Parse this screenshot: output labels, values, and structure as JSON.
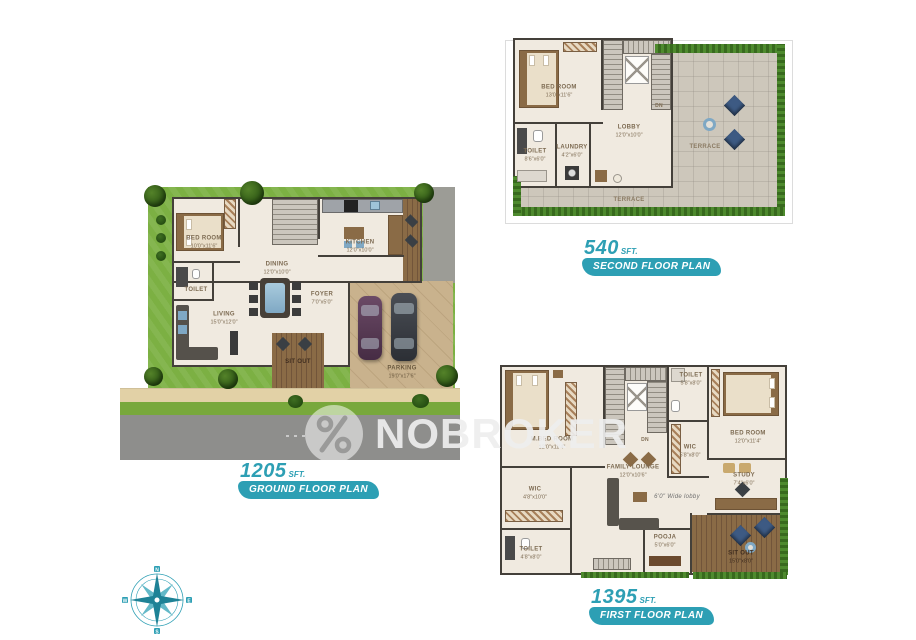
{
  "brand": {
    "watermark": "NOBROKER"
  },
  "ground_floor": {
    "area": "1205",
    "unit": "SFT.",
    "badge": "GROUND FLOOR PLAN",
    "rooms": {
      "bedroom": {
        "name": "BED ROOM",
        "dims": "10'0\"x11'6\""
      },
      "toilet": {
        "name": "TOILET",
        "dims": "7'0\"x5'0\""
      },
      "dining": {
        "name": "DINING",
        "dims": "12'0\"x10'0\""
      },
      "kitchen": {
        "name": "KITCHEN",
        "dims": "12'0\"x10'0\""
      },
      "living": {
        "name": "LIVING",
        "dims": "15'0\"x12'0\""
      },
      "foyer": {
        "name": "FOYER",
        "dims": "7'0\"x5'0\""
      },
      "sitout": {
        "name": "SIT OUT",
        "dims": "12'0\"x6'0\""
      },
      "parking": {
        "name": "PARKING",
        "dims": "19'0\"x17'6\""
      }
    }
  },
  "second_floor": {
    "area": "540",
    "unit": "SFT.",
    "badge": "SECOND FLOOR PLAN",
    "rooms": {
      "bedroom": {
        "name": "BED ROOM",
        "dims": "13'0\"x11'6\""
      },
      "toilet": {
        "name": "TOILET",
        "dims": "8'6\"x6'0\""
      },
      "laundry": {
        "name": "LAUNDRY",
        "dims": "4'2\"x6'0\""
      },
      "lobby": {
        "name": "LOBBY",
        "dims": "12'0\"x10'0\""
      },
      "terrace_right": {
        "name": "TERRACE"
      },
      "terrace_bottom": {
        "name": "TERRACE"
      },
      "stairs": {
        "name": "DN"
      }
    }
  },
  "first_floor": {
    "area": "1395",
    "unit": "SFT.",
    "badge": "FIRST FLOOR PLAN",
    "rooms": {
      "master_bedroom": {
        "name": "M.BED ROOM",
        "dims": "12'0\"x11'4\""
      },
      "toilet_top": {
        "name": "TOILET",
        "dims": "5'8\"x8'0\""
      },
      "bedroom": {
        "name": "BED ROOM",
        "dims": "12'0\"x11'4\""
      },
      "wic_center": {
        "name": "WIC",
        "dims": "5'8\"x8'0\""
      },
      "family_lounge": {
        "name": "FAMILY LOUNGE",
        "dims": "12'0\"x10'6\""
      },
      "lobby_note": {
        "name": "6'0\" Wide lobby"
      },
      "study": {
        "name": "STUDY",
        "dims": "7'4\"x6'0\""
      },
      "pooja": {
        "name": "POOJA",
        "dims": "5'0\"x6'0\""
      },
      "sitout": {
        "name": "SIT OUT",
        "dims": "15'0\"x8'0\""
      },
      "wic_left": {
        "name": "WIC",
        "dims": "4'8\"x10'0\""
      },
      "toilet_left": {
        "name": "TOILET",
        "dims": "4'8\"x8'0\""
      },
      "stairs": {
        "name": "DN"
      }
    }
  },
  "compass": {
    "north": "N",
    "east": "E",
    "south": "S",
    "west": "W"
  },
  "colors": {
    "accent_teal": "#2D9FB4",
    "lawn_green": "#7CB043",
    "road_gray": "#8E8E8C",
    "floor_cream": "#F0EAE0",
    "terrace_gray": "#CDC7BB",
    "wood_brown": "#8A6B46"
  }
}
